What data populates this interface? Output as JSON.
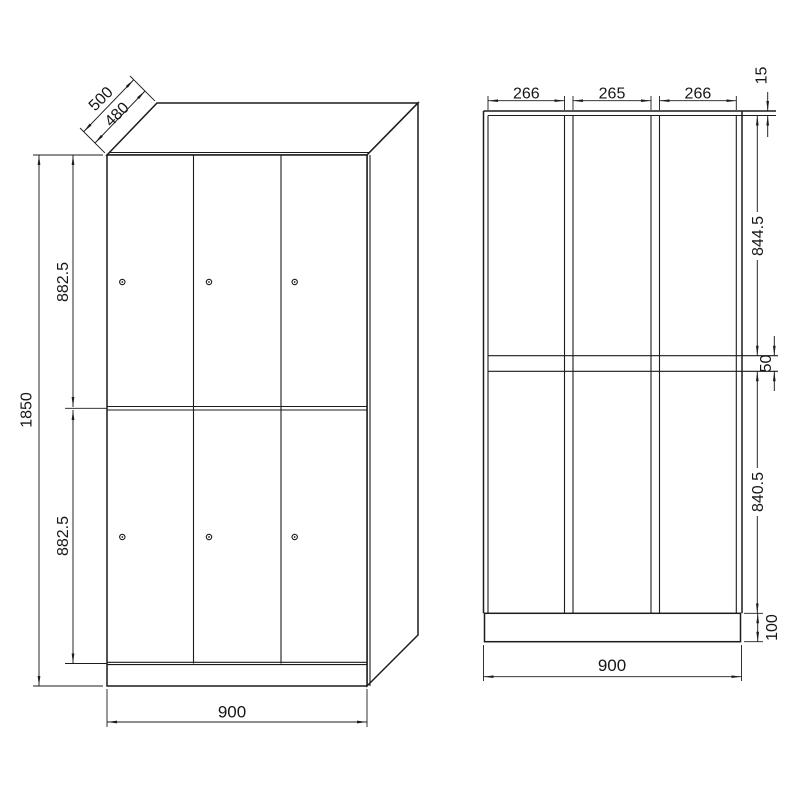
{
  "title": "locker-dimension-drawing",
  "colors": {
    "line": "#1c1c1c",
    "background": "#ffffff"
  },
  "views": {
    "isometric": {
      "label": "front-isometric-view",
      "dims": {
        "depth_outer": "500",
        "depth_inner": "480",
        "total_height": "1850",
        "upper_door_height": "882.5",
        "lower_door_height": "882.5",
        "width": "900"
      }
    },
    "section": {
      "label": "front-section-view",
      "dims": {
        "bay_left": "266",
        "bay_middle": "265",
        "bay_right": "266",
        "top_clearance": "15",
        "upper_compartment": "844.5",
        "shelf_gap": "50",
        "lower_compartment": "840.5",
        "plinth_height": "100",
        "width": "900"
      }
    }
  }
}
